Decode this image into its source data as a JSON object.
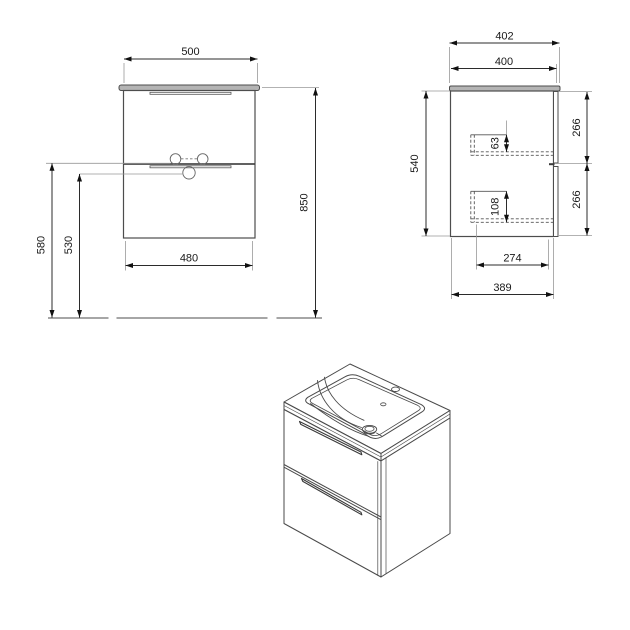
{
  "colors": {
    "object_line": "#4d4d4d",
    "dim_line": "#2b2b2b",
    "ext_line": "#999999",
    "dashed_line": "#555555",
    "slab_fill": "#b4b4b4",
    "text": "#1a1a1a",
    "background": "#ffffff"
  },
  "front_view": {
    "top_width": "500",
    "total_height": "850",
    "handle_height_upper": "580",
    "handle_height_lower": "530",
    "bottom_width": "480"
  },
  "side_view": {
    "top_depth": "402",
    "body_depth": "400",
    "body_height": "540",
    "upper_front_height": "266",
    "lower_front_height": "266",
    "upper_drawer_inset": "63",
    "lower_drawer_inset": "108",
    "drawer_inner_depth": "274",
    "carcass_depth": "389"
  }
}
